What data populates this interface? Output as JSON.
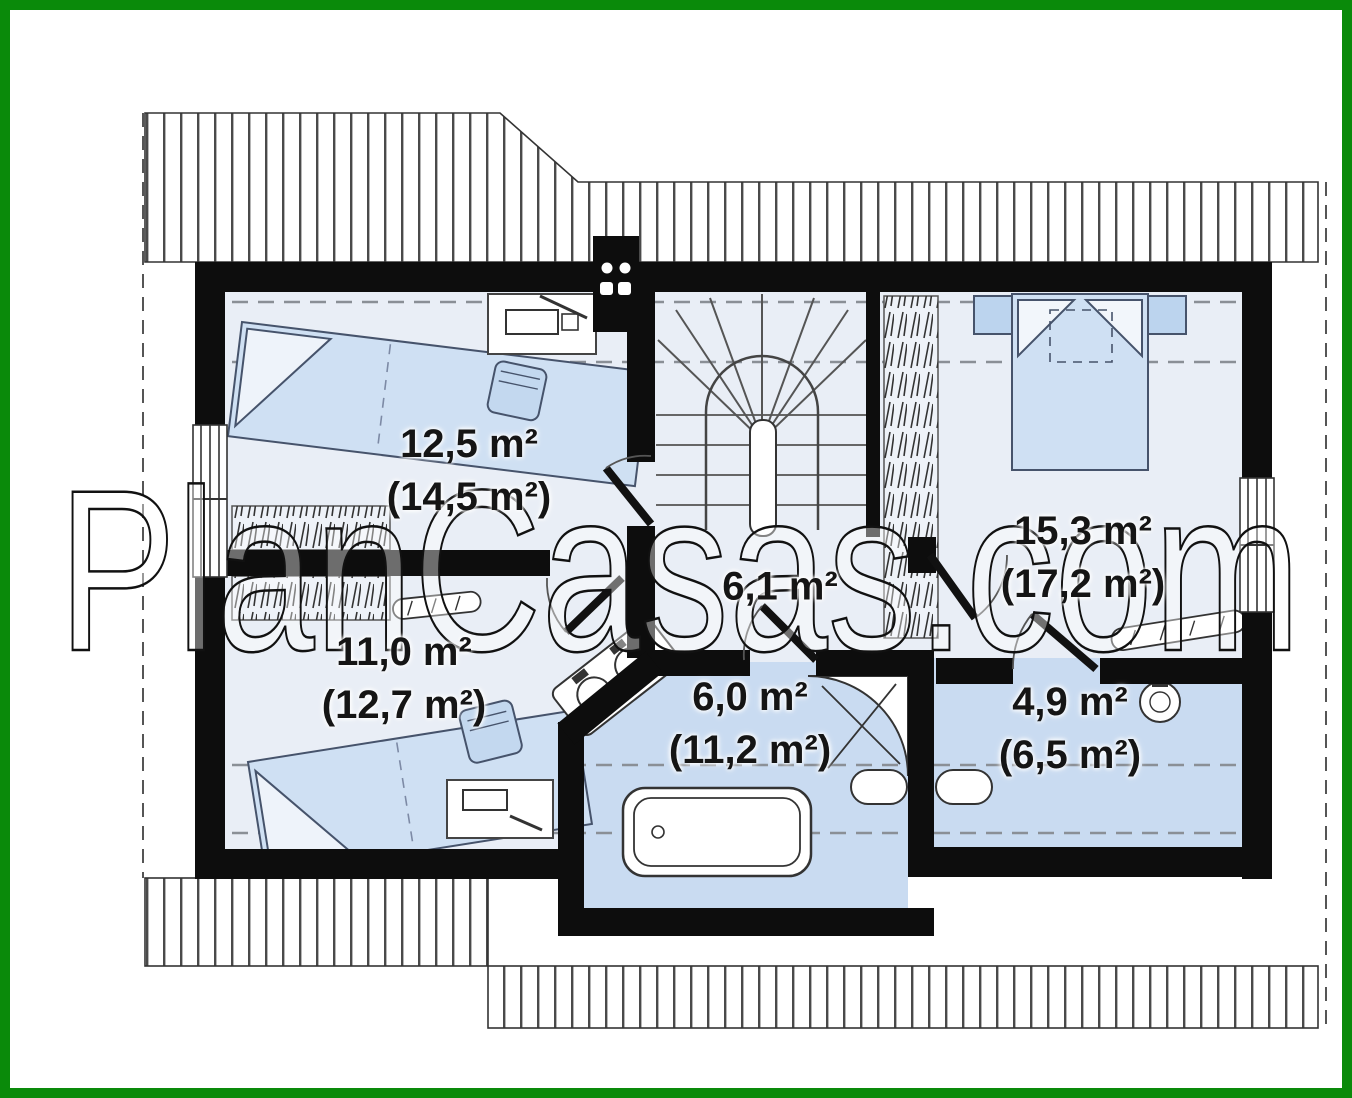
{
  "watermark": "PlanCasas.com",
  "plan": {
    "type": "attic-floor-plan",
    "rooms": [
      {
        "name": "bedroom-top-left",
        "area": "12,5 m²",
        "area_gross": "(14,5 m²)"
      },
      {
        "name": "bedroom-bottom-left",
        "area": "11,0 m²",
        "area_gross": "(12,7 m²)"
      },
      {
        "name": "hall",
        "area": "6,1 m²",
        "area_gross": ""
      },
      {
        "name": "bathroom",
        "area": "6,0 m²",
        "area_gross": "(11,2 m²)"
      },
      {
        "name": "bedroom-right",
        "area": "15,3 m²",
        "area_gross": "(17,2 m²)"
      },
      {
        "name": "bathroom-small",
        "area": "4,9 m²",
        "area_gross": "(6,5 m²)"
      }
    ]
  },
  "colors": {
    "frame_green": "#0a8a0a",
    "floor_light": "#e9eef6",
    "floor_blue": "#c9dbf1",
    "furniture_blue": "#cfe0f3",
    "wall_black": "#0d0d0d",
    "label_text": "#151515"
  }
}
